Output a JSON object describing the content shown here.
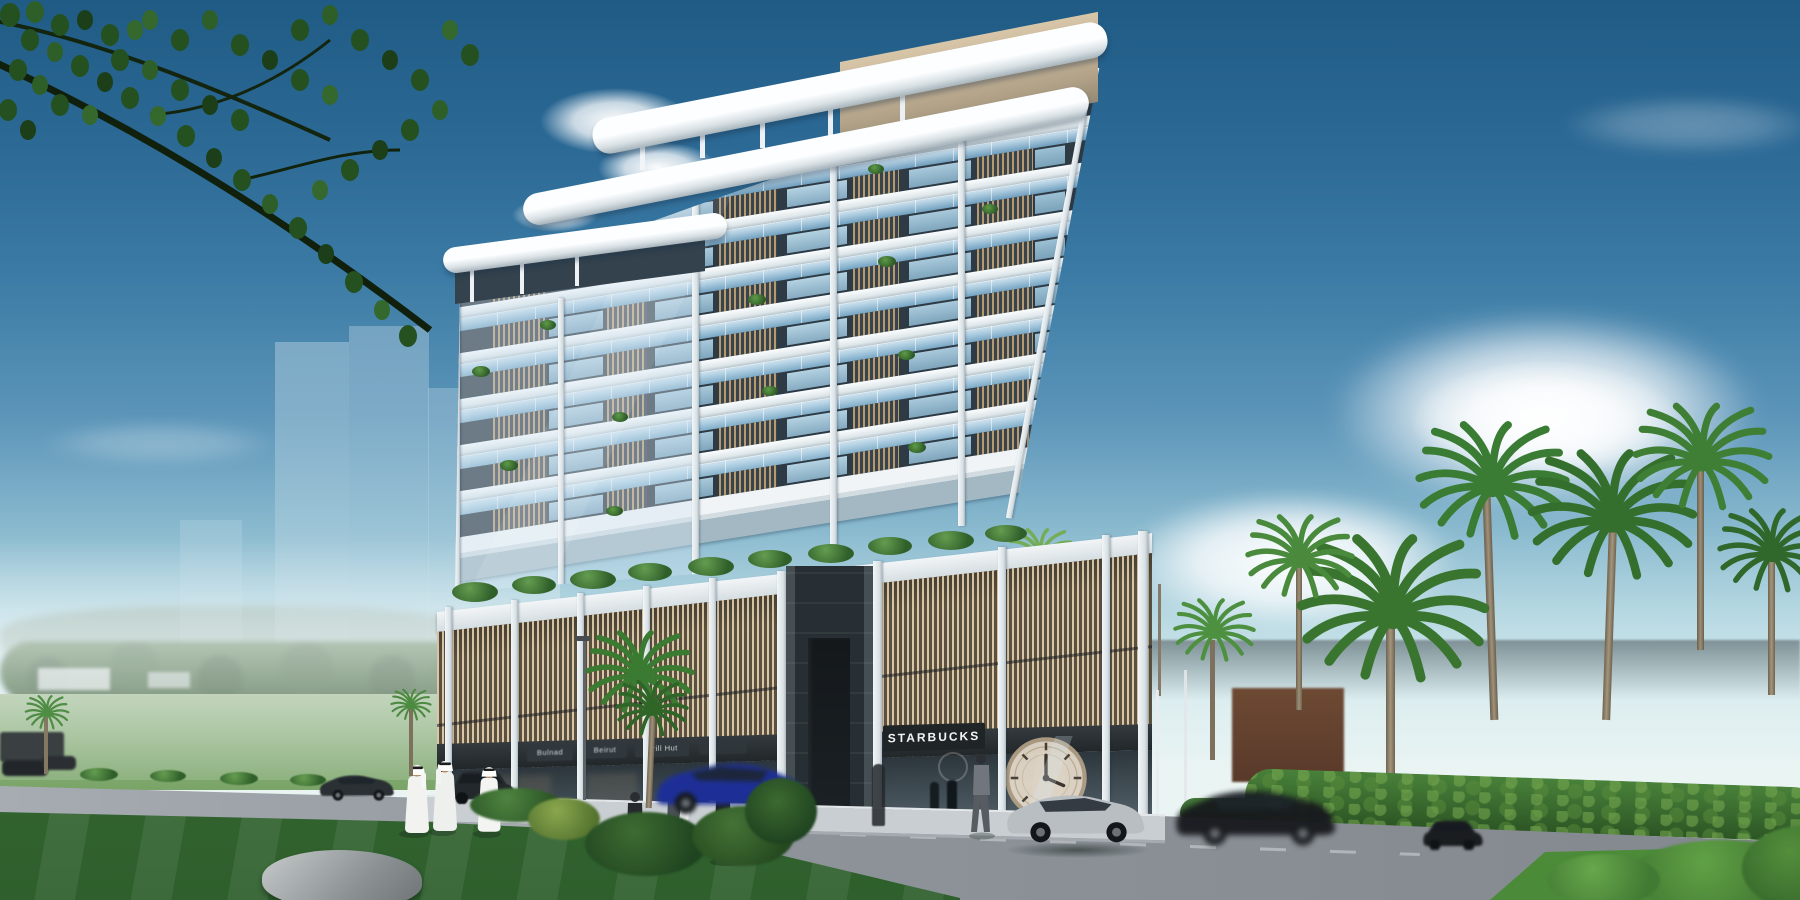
{
  "signs": {
    "shop1": "Bulnad",
    "shop2": "Beirut",
    "shop3": "Grill Hut",
    "starbucks": "STARBUCKS"
  },
  "palette": {
    "sky_top": "#1f5b84",
    "sky_horizon": "#eaf4f3",
    "slab_white": "#f0f4f6",
    "facade_dark": "#2e3a44",
    "louver_tan": "#b59a70",
    "glass_blue": "#9fc3d8",
    "grass_green": "#3e7c39",
    "road_grey": "#8e949a",
    "sign_plate": "#23282c",
    "sign_text": "#f5f7f8"
  }
}
